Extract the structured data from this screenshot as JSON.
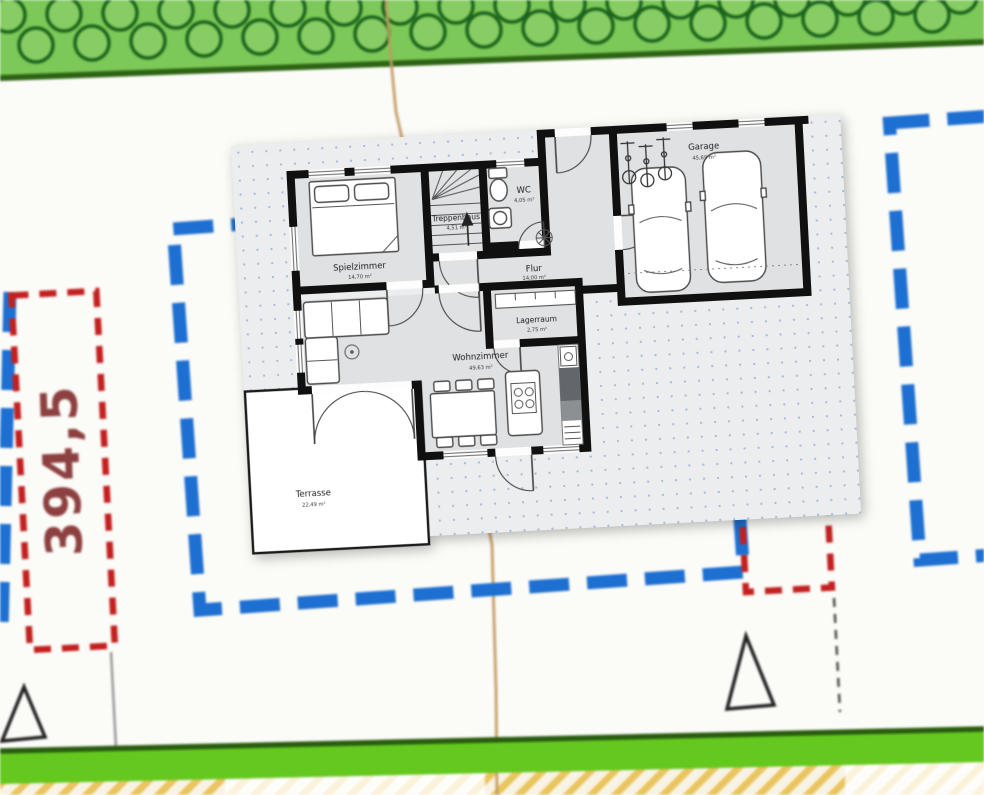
{
  "map": {
    "parcel_label": "394,5",
    "colors": {
      "building_outline_blue": "#1d6fd1",
      "parcel_dashed_red": "#c32020",
      "greenery_fill": "#7cc858",
      "greenery_dark": "#2d6414",
      "boundary_path": "#c49a62",
      "bottom_strip": "#64c81e",
      "hatch_yellow": "#eac55e"
    },
    "symbols": {
      "trees": "tree-icons",
      "survey_marker": "triangle-marker-icon"
    }
  },
  "floorplan": {
    "rooms": [
      {
        "id": "spielzimmer",
        "name": "Spielzimmer",
        "area": "14,70 m²"
      },
      {
        "id": "treppenhaus",
        "name": "Treppenhaus",
        "area": "4,51 m²"
      },
      {
        "id": "wc",
        "name": "WC",
        "area": "4,05 m²"
      },
      {
        "id": "flur",
        "name": "Flur",
        "area": "14,00 m²"
      },
      {
        "id": "garage",
        "name": "Garage",
        "area": "45,69 m²"
      },
      {
        "id": "lagerraum",
        "name": "Lagerraum",
        "area": "2,75 m²"
      },
      {
        "id": "wohnzimmer",
        "name": "Wohnzimmer",
        "area": "49,63 m²"
      },
      {
        "id": "terrasse",
        "name": "Terrasse",
        "area": "22,49 m²"
      }
    ]
  }
}
